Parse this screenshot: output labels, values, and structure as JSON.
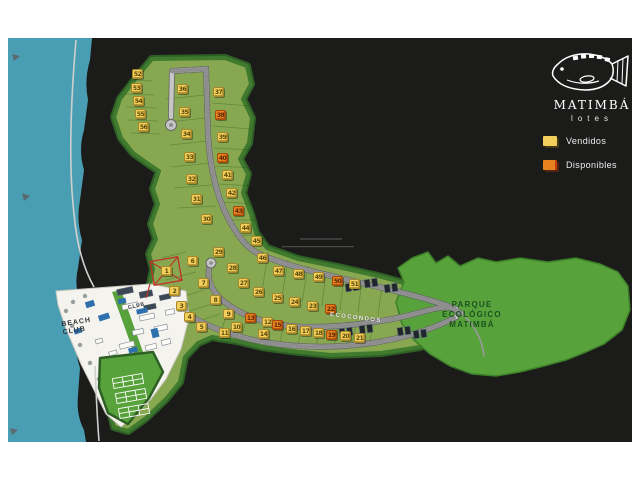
{
  "logo": {
    "brand": "MATIMBÁ",
    "subtitle": "lotes"
  },
  "legend": {
    "items": [
      {
        "label": "Vendidos",
        "status": "vendido"
      },
      {
        "label": "Disponibles",
        "status": "disponible"
      }
    ]
  },
  "labels": {
    "park": [
      "PARQUE",
      "ECOLÓGICO",
      "MATIMBÁ"
    ],
    "ecocondos": "ECOCONDOS",
    "beach_club": [
      "BEACH",
      "CLUB"
    ],
    "club": "CLUB"
  },
  "colors": {
    "page_bg": "#ffffff",
    "land": "#1b1b1a",
    "water": "#4a9eb3",
    "dev_green": "#87a851",
    "dev_border": "#3f7a2e",
    "park_green": "#57a23b",
    "road": "#c6c6c6",
    "vendido": "#f2cf5b",
    "disponible": "#e8821e",
    "marker_red": "#c03028"
  },
  "lots": [
    {
      "n": 1,
      "x": 166,
      "y": 271,
      "status": "vendido",
      "marked": true
    },
    {
      "n": 2,
      "x": 174,
      "y": 291,
      "status": "vendido"
    },
    {
      "n": 3,
      "x": 181,
      "y": 306,
      "status": "vendido"
    },
    {
      "n": 4,
      "x": 189,
      "y": 317,
      "status": "vendido"
    },
    {
      "n": 5,
      "x": 201,
      "y": 327,
      "status": "vendido"
    },
    {
      "n": 6,
      "x": 192,
      "y": 261,
      "status": "vendido"
    },
    {
      "n": 7,
      "x": 203,
      "y": 283,
      "status": "vendido"
    },
    {
      "n": 8,
      "x": 215,
      "y": 300,
      "status": "vendido"
    },
    {
      "n": 9,
      "x": 228,
      "y": 314,
      "status": "vendido"
    },
    {
      "n": 10,
      "x": 236,
      "y": 327,
      "status": "vendido"
    },
    {
      "n": 11,
      "x": 224,
      "y": 333,
      "status": "vendido"
    },
    {
      "n": 12,
      "x": 267,
      "y": 322,
      "status": "vendido"
    },
    {
      "n": 13,
      "x": 250,
      "y": 318,
      "status": "disponible"
    },
    {
      "n": 14,
      "x": 263,
      "y": 334,
      "status": "vendido"
    },
    {
      "n": 15,
      "x": 277,
      "y": 325,
      "status": "disponible"
    },
    {
      "n": 16,
      "x": 291,
      "y": 329,
      "status": "vendido"
    },
    {
      "n": 17,
      "x": 305,
      "y": 331,
      "status": "vendido"
    },
    {
      "n": 18,
      "x": 318,
      "y": 333,
      "status": "vendido"
    },
    {
      "n": 19,
      "x": 331,
      "y": 335,
      "status": "disponible"
    },
    {
      "n": 20,
      "x": 345,
      "y": 336,
      "status": "vendido"
    },
    {
      "n": 21,
      "x": 359,
      "y": 338,
      "status": "vendido"
    },
    {
      "n": 22,
      "x": 330,
      "y": 309,
      "status": "disponible"
    },
    {
      "n": 23,
      "x": 312,
      "y": 306,
      "status": "vendido"
    },
    {
      "n": 24,
      "x": 294,
      "y": 302,
      "status": "vendido"
    },
    {
      "n": 25,
      "x": 277,
      "y": 298,
      "status": "vendido"
    },
    {
      "n": 26,
      "x": 258,
      "y": 292,
      "status": "vendido"
    },
    {
      "n": 27,
      "x": 243,
      "y": 283,
      "status": "vendido"
    },
    {
      "n": 28,
      "x": 232,
      "y": 268,
      "status": "vendido"
    },
    {
      "n": 29,
      "x": 218,
      "y": 252,
      "status": "vendido"
    },
    {
      "n": 30,
      "x": 206,
      "y": 219,
      "status": "vendido"
    },
    {
      "n": 31,
      "x": 196,
      "y": 199,
      "status": "vendido"
    },
    {
      "n": 32,
      "x": 191,
      "y": 179,
      "status": "vendido"
    },
    {
      "n": 33,
      "x": 189,
      "y": 157,
      "status": "vendido"
    },
    {
      "n": 34,
      "x": 186,
      "y": 134,
      "status": "vendido"
    },
    {
      "n": 35,
      "x": 184,
      "y": 112,
      "status": "vendido"
    },
    {
      "n": 36,
      "x": 182,
      "y": 89,
      "status": "vendido"
    },
    {
      "n": 37,
      "x": 218,
      "y": 92,
      "status": "vendido"
    },
    {
      "n": 38,
      "x": 220,
      "y": 115,
      "status": "disponible"
    },
    {
      "n": 39,
      "x": 222,
      "y": 137,
      "status": "vendido"
    },
    {
      "n": 40,
      "x": 222,
      "y": 158,
      "status": "disponible"
    },
    {
      "n": 41,
      "x": 227,
      "y": 175,
      "status": "vendido"
    },
    {
      "n": 42,
      "x": 231,
      "y": 193,
      "status": "vendido"
    },
    {
      "n": 43,
      "x": 238,
      "y": 211,
      "status": "disponible"
    },
    {
      "n": 44,
      "x": 245,
      "y": 228,
      "status": "vendido"
    },
    {
      "n": 45,
      "x": 256,
      "y": 241,
      "status": "vendido"
    },
    {
      "n": 46,
      "x": 262,
      "y": 258,
      "status": "vendido"
    },
    {
      "n": 47,
      "x": 278,
      "y": 271,
      "status": "vendido"
    },
    {
      "n": 48,
      "x": 298,
      "y": 274,
      "status": "vendido"
    },
    {
      "n": 49,
      "x": 318,
      "y": 277,
      "status": "vendido"
    },
    {
      "n": 50,
      "x": 337,
      "y": 281,
      "status": "disponible"
    },
    {
      "n": 51,
      "x": 354,
      "y": 284,
      "status": "vendido"
    },
    {
      "n": 52,
      "x": 137,
      "y": 74,
      "status": "vendido"
    },
    {
      "n": 53,
      "x": 136,
      "y": 88,
      "status": "vendido"
    },
    {
      "n": 54,
      "x": 138,
      "y": 101,
      "status": "vendido"
    },
    {
      "n": 55,
      "x": 140,
      "y": 114,
      "status": "vendido"
    },
    {
      "n": 56,
      "x": 143,
      "y": 127,
      "status": "vendido"
    }
  ]
}
